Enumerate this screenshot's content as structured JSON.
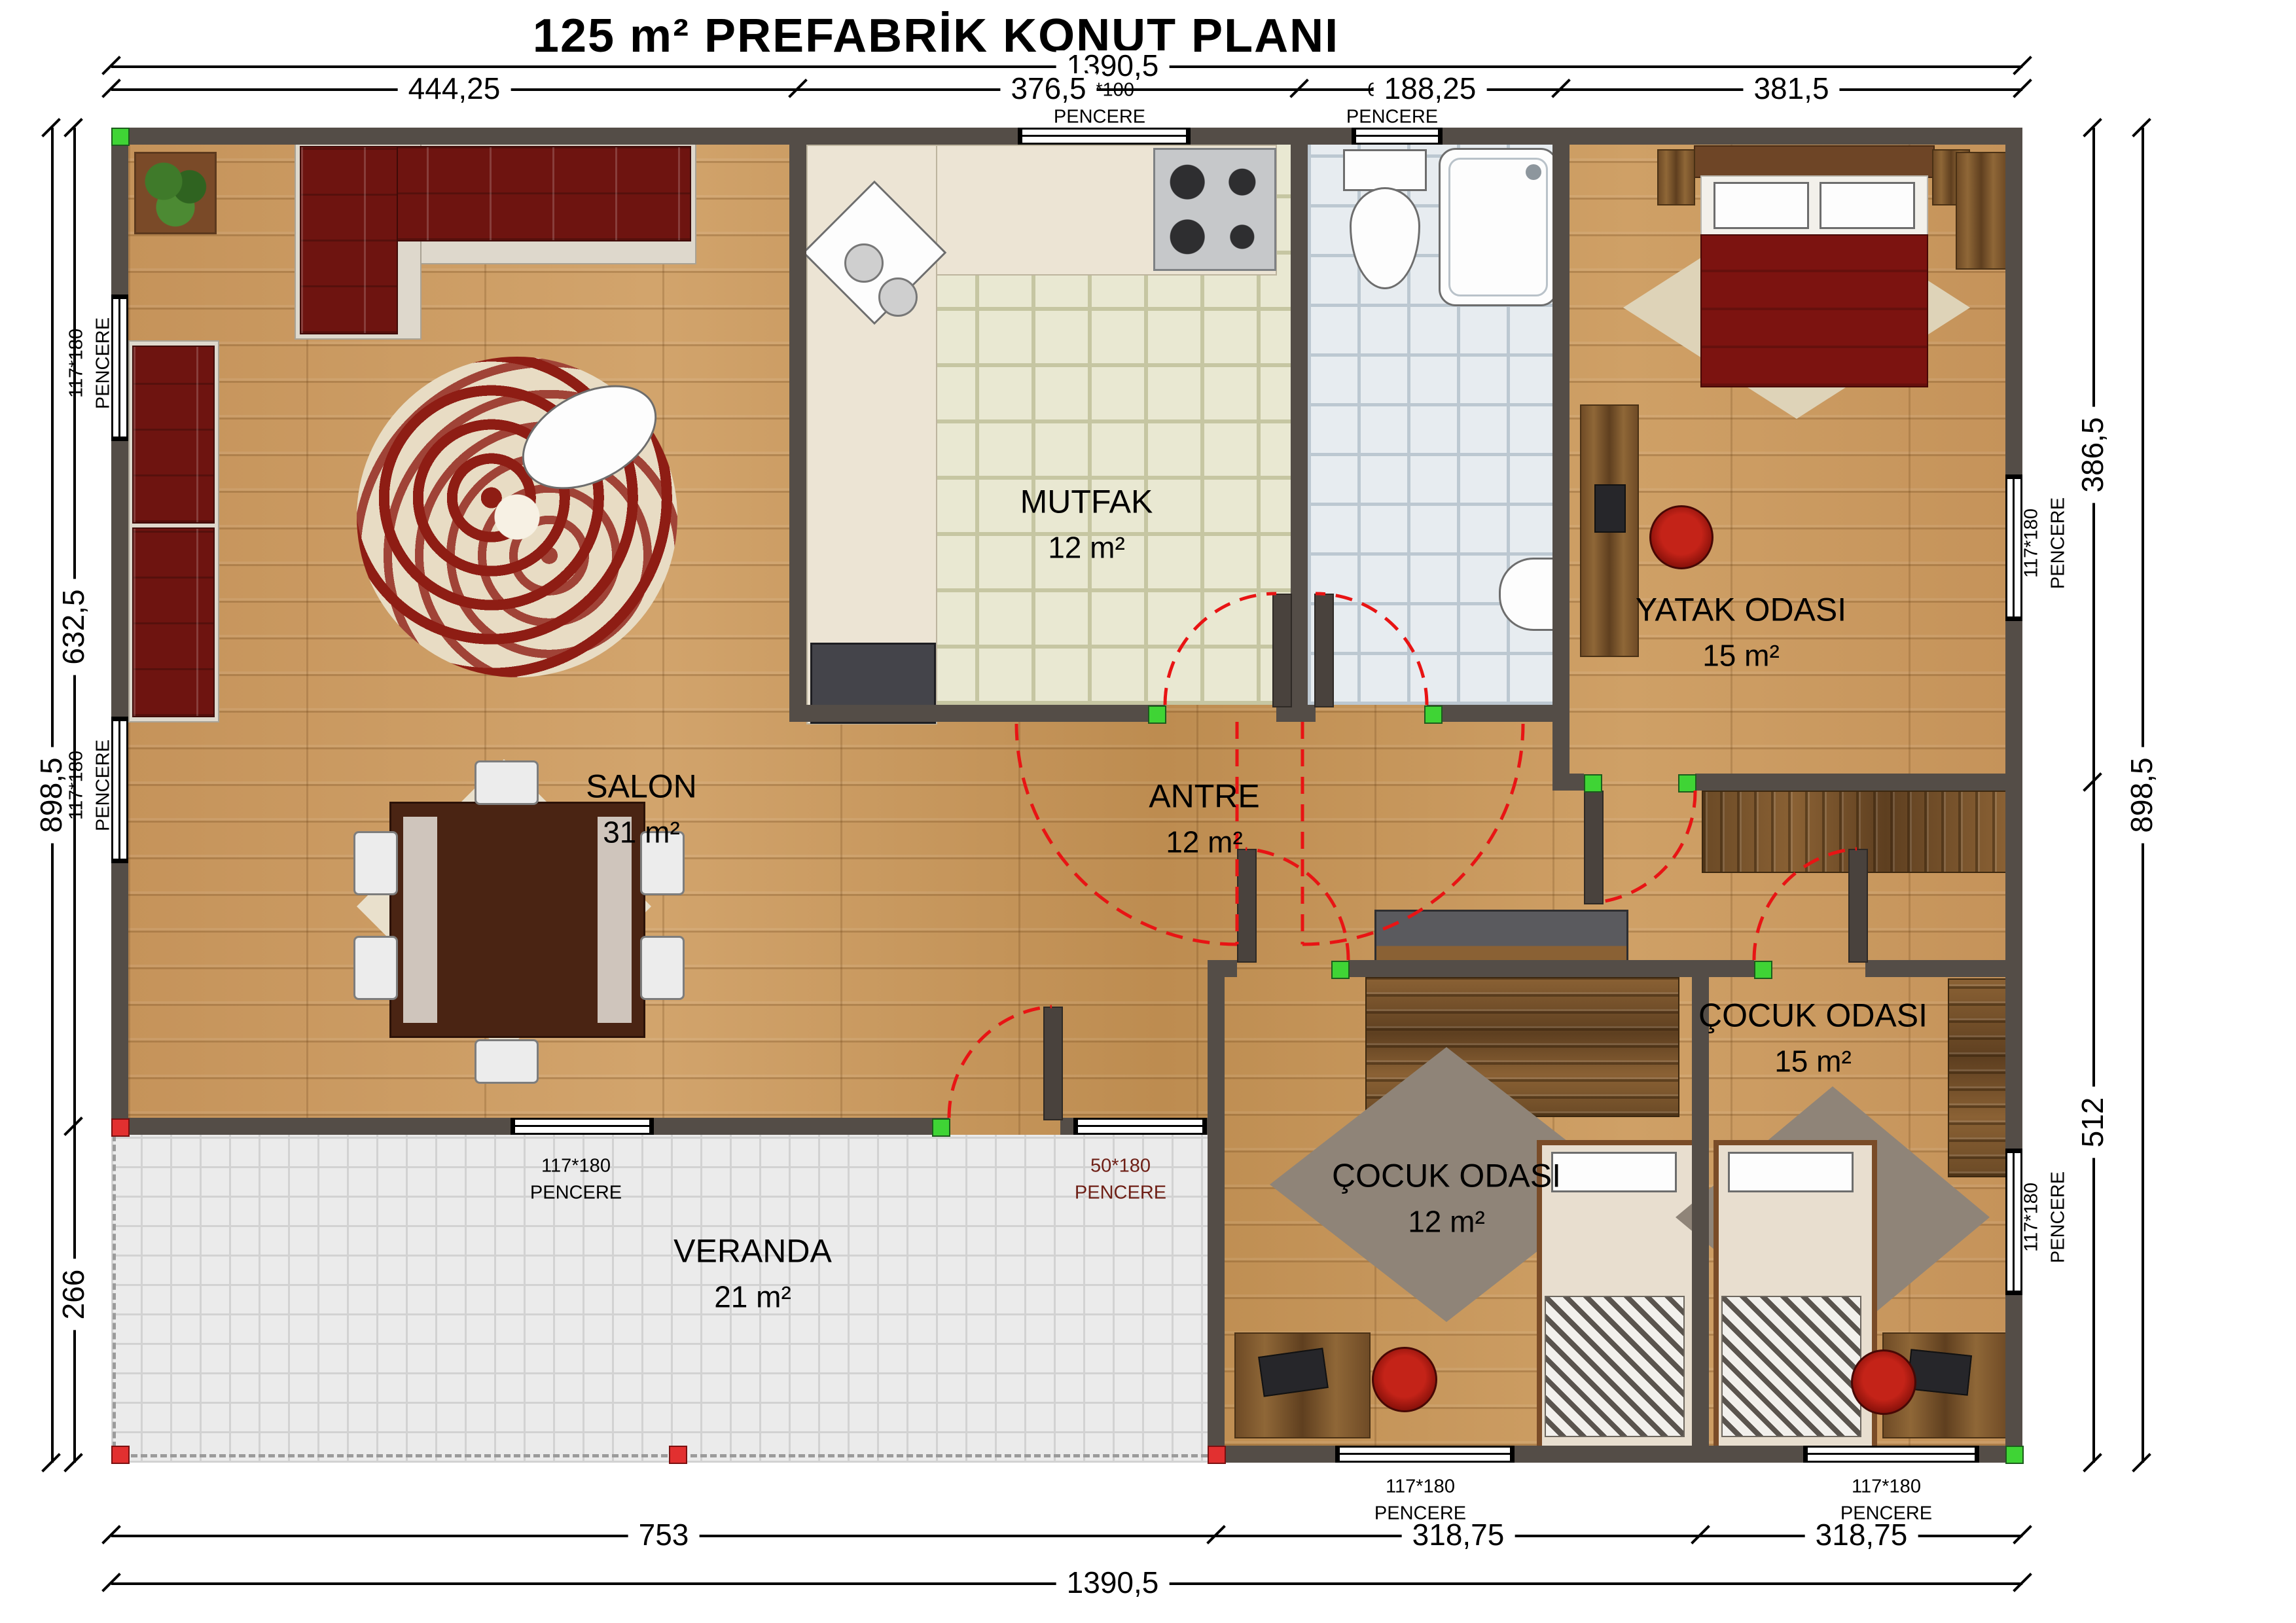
{
  "title": "125 m² PREFABRİK KONUT PLANI",
  "dimensions": {
    "top_total": "1390,5",
    "top_segments": [
      "444,25",
      "376,5",
      "188,25",
      "381,5"
    ],
    "bottom_segments": [
      "753",
      "318,75",
      "318,75"
    ],
    "bottom_total": "1390,5",
    "left_outer": "898,5",
    "left_segments": [
      "632,5",
      "266"
    ],
    "right_outer": "898,5",
    "right_segments": [
      "386,5",
      "512"
    ]
  },
  "rooms": {
    "salon": {
      "name": "SALON",
      "area": "31 m²"
    },
    "mutfak": {
      "name": "MUTFAK",
      "area": "12 m²"
    },
    "antre": {
      "name": "ANTRE",
      "area": "12 m²"
    },
    "yatak": {
      "name": "YATAK ODASI",
      "area": "15 m²"
    },
    "cocuk15": {
      "name": "ÇOCUK ODASI",
      "area": "15 m²"
    },
    "cocuk12": {
      "name": "ÇOCUK ODASI",
      "area": "12 m²"
    },
    "veranda": {
      "name": "VERANDA",
      "area": "21 m²"
    }
  },
  "windows": {
    "kitchen_top": {
      "size": "117*100",
      "label": "PENCERE"
    },
    "bath_top": {
      "size": "60*40",
      "label": "PENCERE"
    },
    "salon_left_upper": {
      "size": "117*180",
      "label": "PENCERE"
    },
    "salon_left_lower": {
      "size": "117*180",
      "label": "PENCERE"
    },
    "bedroom_right": {
      "size": "117*180",
      "label": "PENCERE"
    },
    "cocuk15_right": {
      "size": "117*180",
      "label": "PENCERE"
    },
    "salon_bottom": {
      "size": "117*180",
      "label": "PENCERE"
    },
    "veranda_entry": {
      "size": "50*180",
      "label": "PENCERE"
    },
    "cocuk12_bottom": {
      "size": "117*180",
      "label": "PENCERE"
    },
    "cocuk15_bottom": {
      "size": "117*180",
      "label": "PENCERE"
    }
  },
  "colors": {
    "wall": "#544d47",
    "door_swing_red": "#e81414",
    "jamb_green": "#3fd435",
    "veranda_window_label": "#6e1f16",
    "wood_floor": "#c89759"
  }
}
